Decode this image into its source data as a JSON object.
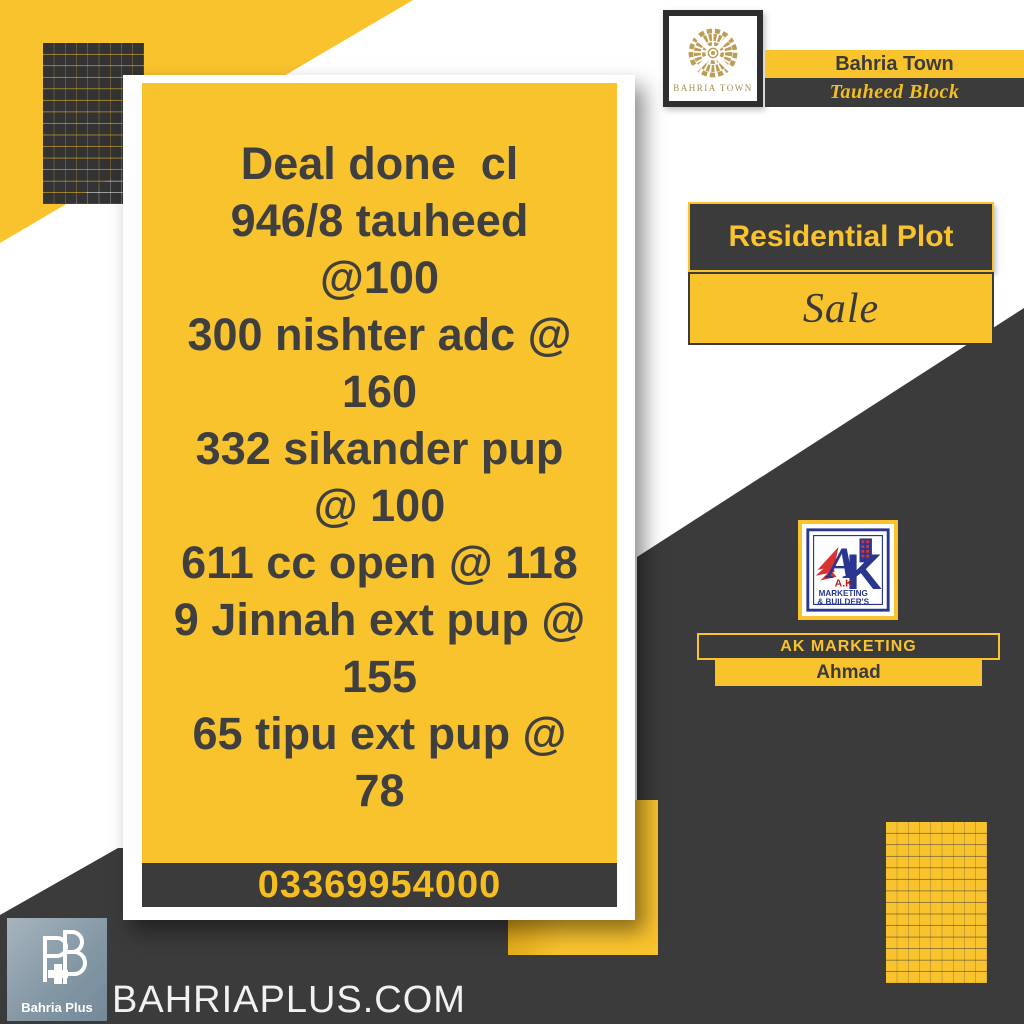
{
  "deal_card": {
    "lines": [
      "Deal done  cl",
      "946/8 tauheed",
      "@100",
      "300 nishter adc @",
      "160",
      "332 sikander pup",
      "@ 100",
      "611 cc open @ 118",
      "9 Jinnah ext pup @",
      "155",
      "65 tipu ext pup @",
      "78"
    ],
    "phone": "03369954000"
  },
  "bahria_badge": {
    "logo_caption": "BAHRIA TOWN",
    "title": "Bahria Town",
    "subtitle": "Tauheed Block"
  },
  "listing": {
    "type_label": "Residential Plot",
    "status_label": "Sale"
  },
  "agent": {
    "logo_name": "A.K",
    "logo_line1": "MARKETING",
    "logo_line2": "& BUILDER'S",
    "logo_letter_a": "A",
    "logo_letter_k": "K",
    "company": "AK MARKETING",
    "agent_name": "Ahmad"
  },
  "footer": {
    "brand_label": "Bahria Plus",
    "website": "BAHRIAPLUS.COM"
  },
  "colors": {
    "yellow": "#F9C32E",
    "charcoal": "#3B3B3B",
    "dot-dark": "#333333",
    "gold": "#BD9C53",
    "navy": "#28368F",
    "red": "#D63333",
    "text-dark": "#3F3F3F",
    "phone-yellow": "#F5BE1E"
  }
}
